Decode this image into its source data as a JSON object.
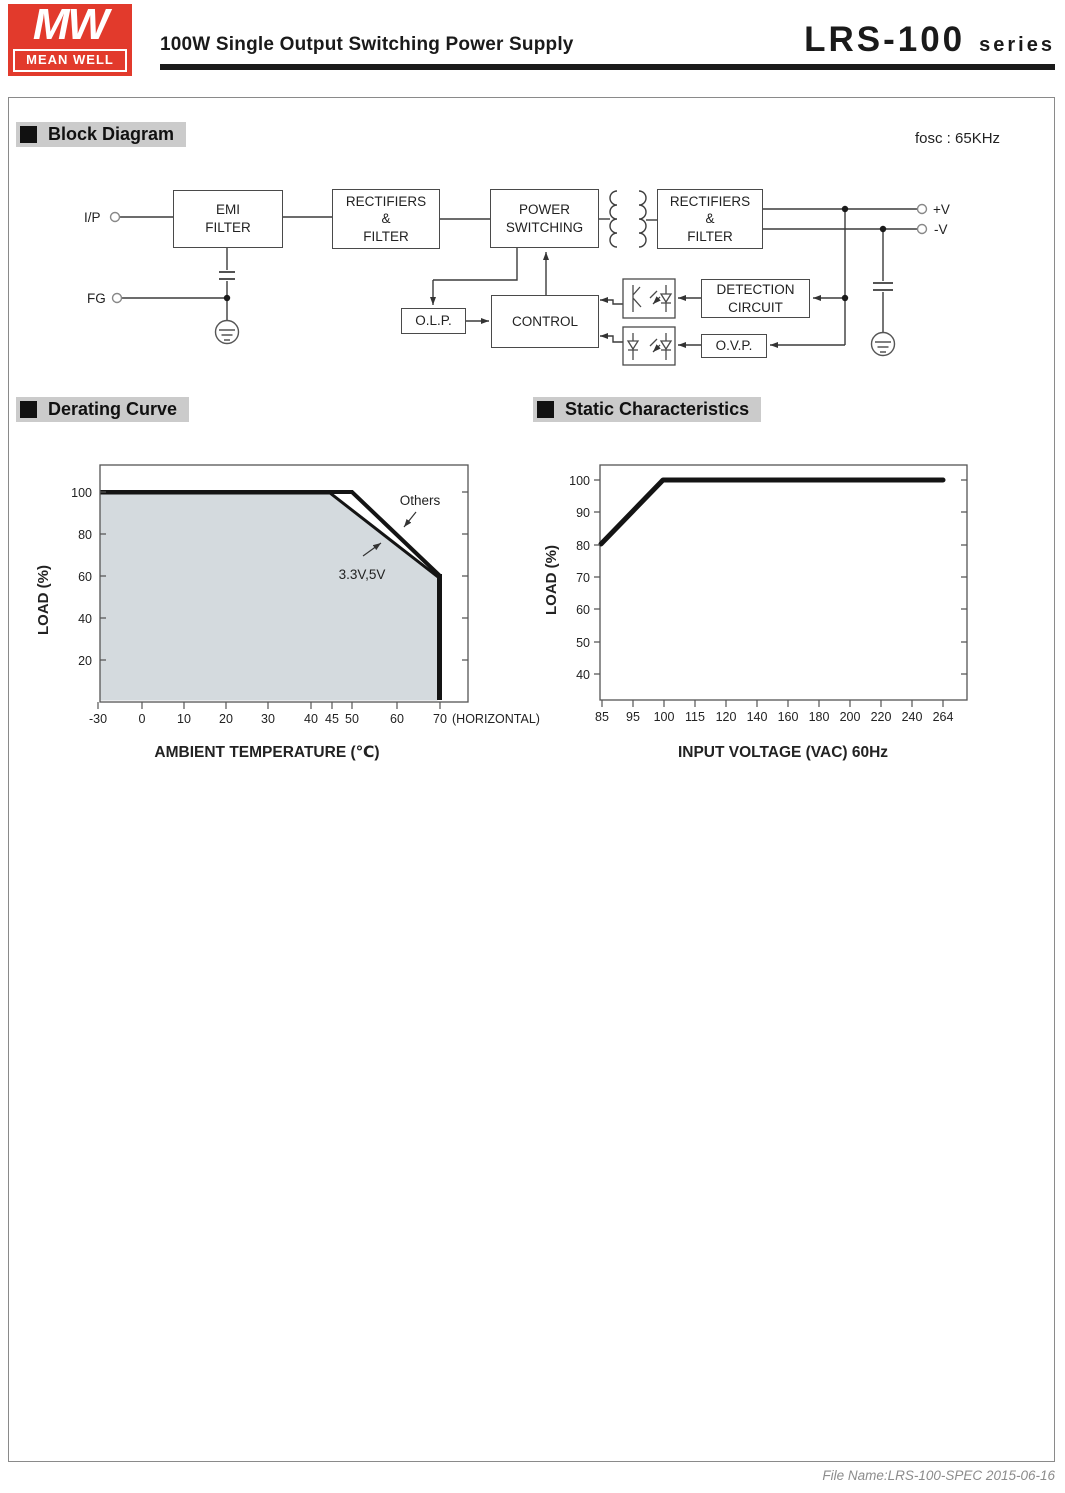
{
  "header": {
    "logo": {
      "monogram": "MW",
      "brand": "MEAN WELL"
    },
    "title": "100W Single Output Switching Power Supply",
    "product": "LRS-100",
    "product_suffix": "series"
  },
  "sections": {
    "block_diagram": "Block Diagram",
    "derating": "Derating Curve",
    "static": "Static Characteristics"
  },
  "block_diagram": {
    "fosc_note": "fosc : 65KHz",
    "terminals": {
      "input": "I/P",
      "ground": "FG",
      "v_plus": "+V",
      "v_minus": "-V"
    },
    "blocks": {
      "emi": {
        "line1": "EMI",
        "line2": "FILTER"
      },
      "rectifier_in": {
        "line1": "RECTIFIERS",
        "line2": "&",
        "line3": "FILTER"
      },
      "power_switching": {
        "line1": "POWER",
        "line2": "SWITCHING"
      },
      "rectifier_out": {
        "line1": "RECTIFIERS",
        "line2": "&",
        "line3": "FILTER"
      },
      "detection": {
        "line1": "DETECTION",
        "line2": "CIRCUIT"
      },
      "control": {
        "line1": "CONTROL"
      },
      "olp": {
        "line1": "O.L.P."
      },
      "ovp": {
        "line1": "O.V.P."
      }
    }
  },
  "chart_data": [
    {
      "type": "line",
      "title": "Derating Curve",
      "xlabel": "AMBIENT TEMPERATURE (℃)",
      "ylabel": "LOAD (%)",
      "x_note": "(HORIZONTAL)",
      "x_ticks": [
        "-30",
        "0",
        "10",
        "20",
        "30",
        "40",
        "45",
        "50",
        "60",
        "70"
      ],
      "y_ticks": [
        "100",
        "80",
        "60",
        "40",
        "20"
      ],
      "ylim": [
        0,
        110
      ],
      "grid": false,
      "area_fill_under": "3.3V,5V",
      "series": [
        {
          "name": "Others",
          "points": [
            [
              -30,
              100
            ],
            [
              50,
              100
            ],
            [
              70,
              60
            ],
            [
              70,
              0
            ]
          ]
        },
        {
          "name": "3.3V,5V",
          "points": [
            [
              -30,
              100
            ],
            [
              45,
              100
            ],
            [
              70,
              60
            ],
            [
              70,
              0
            ]
          ]
        }
      ]
    },
    {
      "type": "line",
      "title": "Static Characteristics",
      "xlabel": "INPUT VOLTAGE (VAC) 60Hz",
      "ylabel": "LOAD (%)",
      "x_ticks": [
        "85",
        "95",
        "100",
        "115",
        "120",
        "140",
        "160",
        "180",
        "200",
        "220",
        "240",
        "264"
      ],
      "y_ticks": [
        "100",
        "90",
        "80",
        "70",
        "60",
        "50",
        "40"
      ],
      "ylim": [
        30,
        105
      ],
      "grid": false,
      "series": [
        {
          "name": "load",
          "points": [
            [
              85,
              80
            ],
            [
              100,
              100
            ],
            [
              264,
              100
            ]
          ]
        }
      ]
    }
  ],
  "footer": {
    "file_note": "File Name:LRS-100-SPEC  2015-06-16"
  },
  "colors": {
    "brand_red": "#e23a2c",
    "section_header_bg": "#cbcbcb",
    "derating_area_fill": "#d4dade",
    "curve_line": "#141414",
    "rule_black": "#1a1a1a"
  }
}
